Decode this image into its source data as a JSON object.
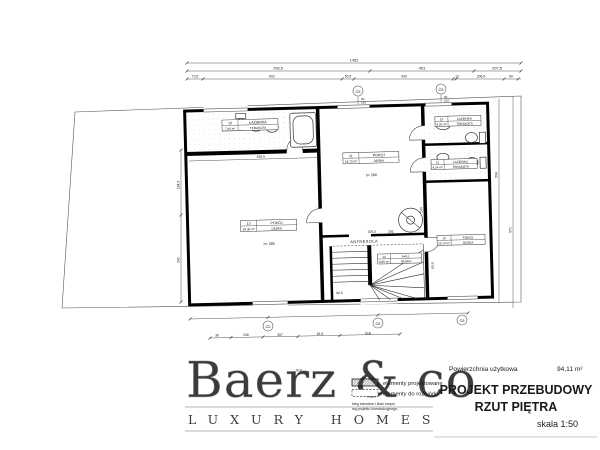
{
  "title_block": {
    "area_label": "Powierzchnia użytkowa",
    "area_value": "94,11 m²",
    "title_line1": "PROJEKT PRZEBUDOWY",
    "title_line2": "RZUT PIĘTRA",
    "scale": "skala 1:50"
  },
  "legend": {
    "projected": "elementy projektowane",
    "demolition": "elementy do rozbiórki",
    "note1": "bieg schodów i ilość stopni",
    "note2": "wg projektu konstrukcyjnego"
  },
  "watermark": {
    "brand": "Baerz & co",
    "tagline": "LUXURY HOMES"
  },
  "rooms": {
    "bath16": {
      "no": "16",
      "name": "ŁAZIENKA",
      "area": "7,04 m²",
      "finish": "TERAKOTA"
    },
    "room13": {
      "no": "13",
      "name": "POKÓJ",
      "area": "34,30 m²",
      "finish": "DESKA",
      "height": "h= 280"
    },
    "room11": {
      "no": "11",
      "name": "POKÓJ",
      "area": "18,70 m²",
      "finish": "DESKA",
      "height": "h= 280"
    },
    "bath15": {
      "no": "15",
      "name": "ŁAZIENKA",
      "area": "4,20 m²",
      "finish": "TERAKOTA"
    },
    "bath12": {
      "no": "12",
      "name": "ŁAZIENKA",
      "area": "4,24 m²",
      "finish": "TERAKOTA"
    },
    "hall14": {
      "no": "14",
      "name": "HALL",
      "area": "9,85 m²",
      "finish": "DESKA"
    },
    "room10": {
      "no": "10",
      "name": "POKÓJ",
      "area": "15,24 m²",
      "finish": "DESKA"
    }
  },
  "labels": {
    "antresola": "ANTRESOLA"
  },
  "markers": {
    "t1": "O3",
    "t2": "O3",
    "b1": "O2",
    "b2": "O2",
    "b3": "O3",
    "t1a": "90",
    "t1b": "150",
    "t2a": "90",
    "t2b": "150"
  },
  "dims": {
    "top_total": "1452",
    "t2a": "793,5",
    "t2b": "451",
    "t2c": "207,5",
    "t3a": "70,5",
    "t3b": "602",
    "t3c": "50,5",
    "t3d": "433",
    "t3e": "12",
    "t3f": "206,5",
    "t3g": "60",
    "ba": "30",
    "bb": "246",
    "bc": "307",
    "be": "61,5",
    "bd": "518",
    "bf": "818",
    "la": "164,5",
    "lb": "240",
    "ra": "594",
    "rb": "570",
    "ia": "435,5",
    "ib": "230",
    "ic": "205,5",
    "id": "282",
    "ie": "90,5",
    "if": "60,5"
  }
}
